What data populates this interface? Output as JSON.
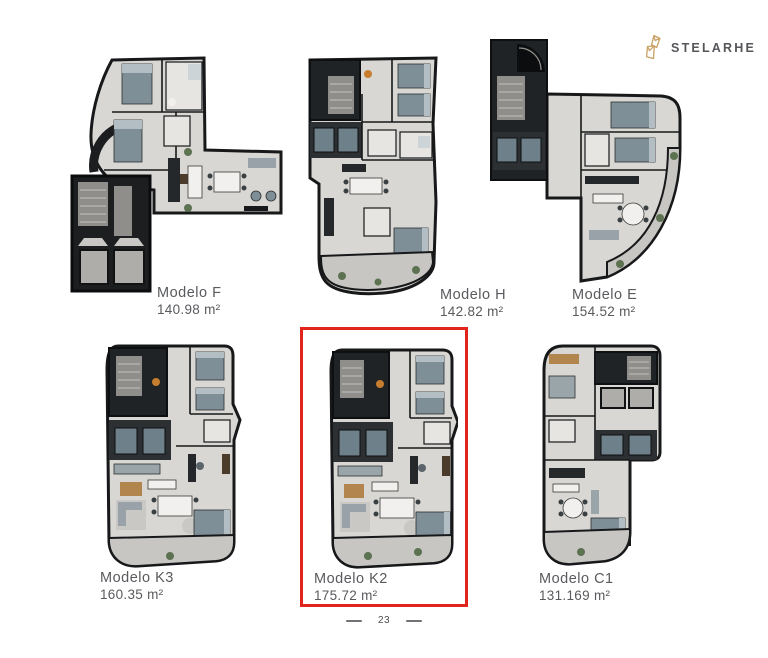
{
  "brand": {
    "name": "STELARHE",
    "accent_color": "#c9a063"
  },
  "page": {
    "number": "23"
  },
  "models": [
    {
      "name": "Modelo F",
      "area": "140.98 m²"
    },
    {
      "name": "Modelo H",
      "area": "142.82 m²"
    },
    {
      "name": "Modelo E",
      "area": "154.52 m²"
    },
    {
      "name": "Modelo K3",
      "area": "160.35 m²"
    },
    {
      "name": "Modelo K2",
      "area": "175.72 m²",
      "highlighted": true
    },
    {
      "name": "Modelo C1",
      "area": "131.169 m²"
    }
  ],
  "highlight": {
    "model": "Modelo K2",
    "color": "#e2251b"
  }
}
